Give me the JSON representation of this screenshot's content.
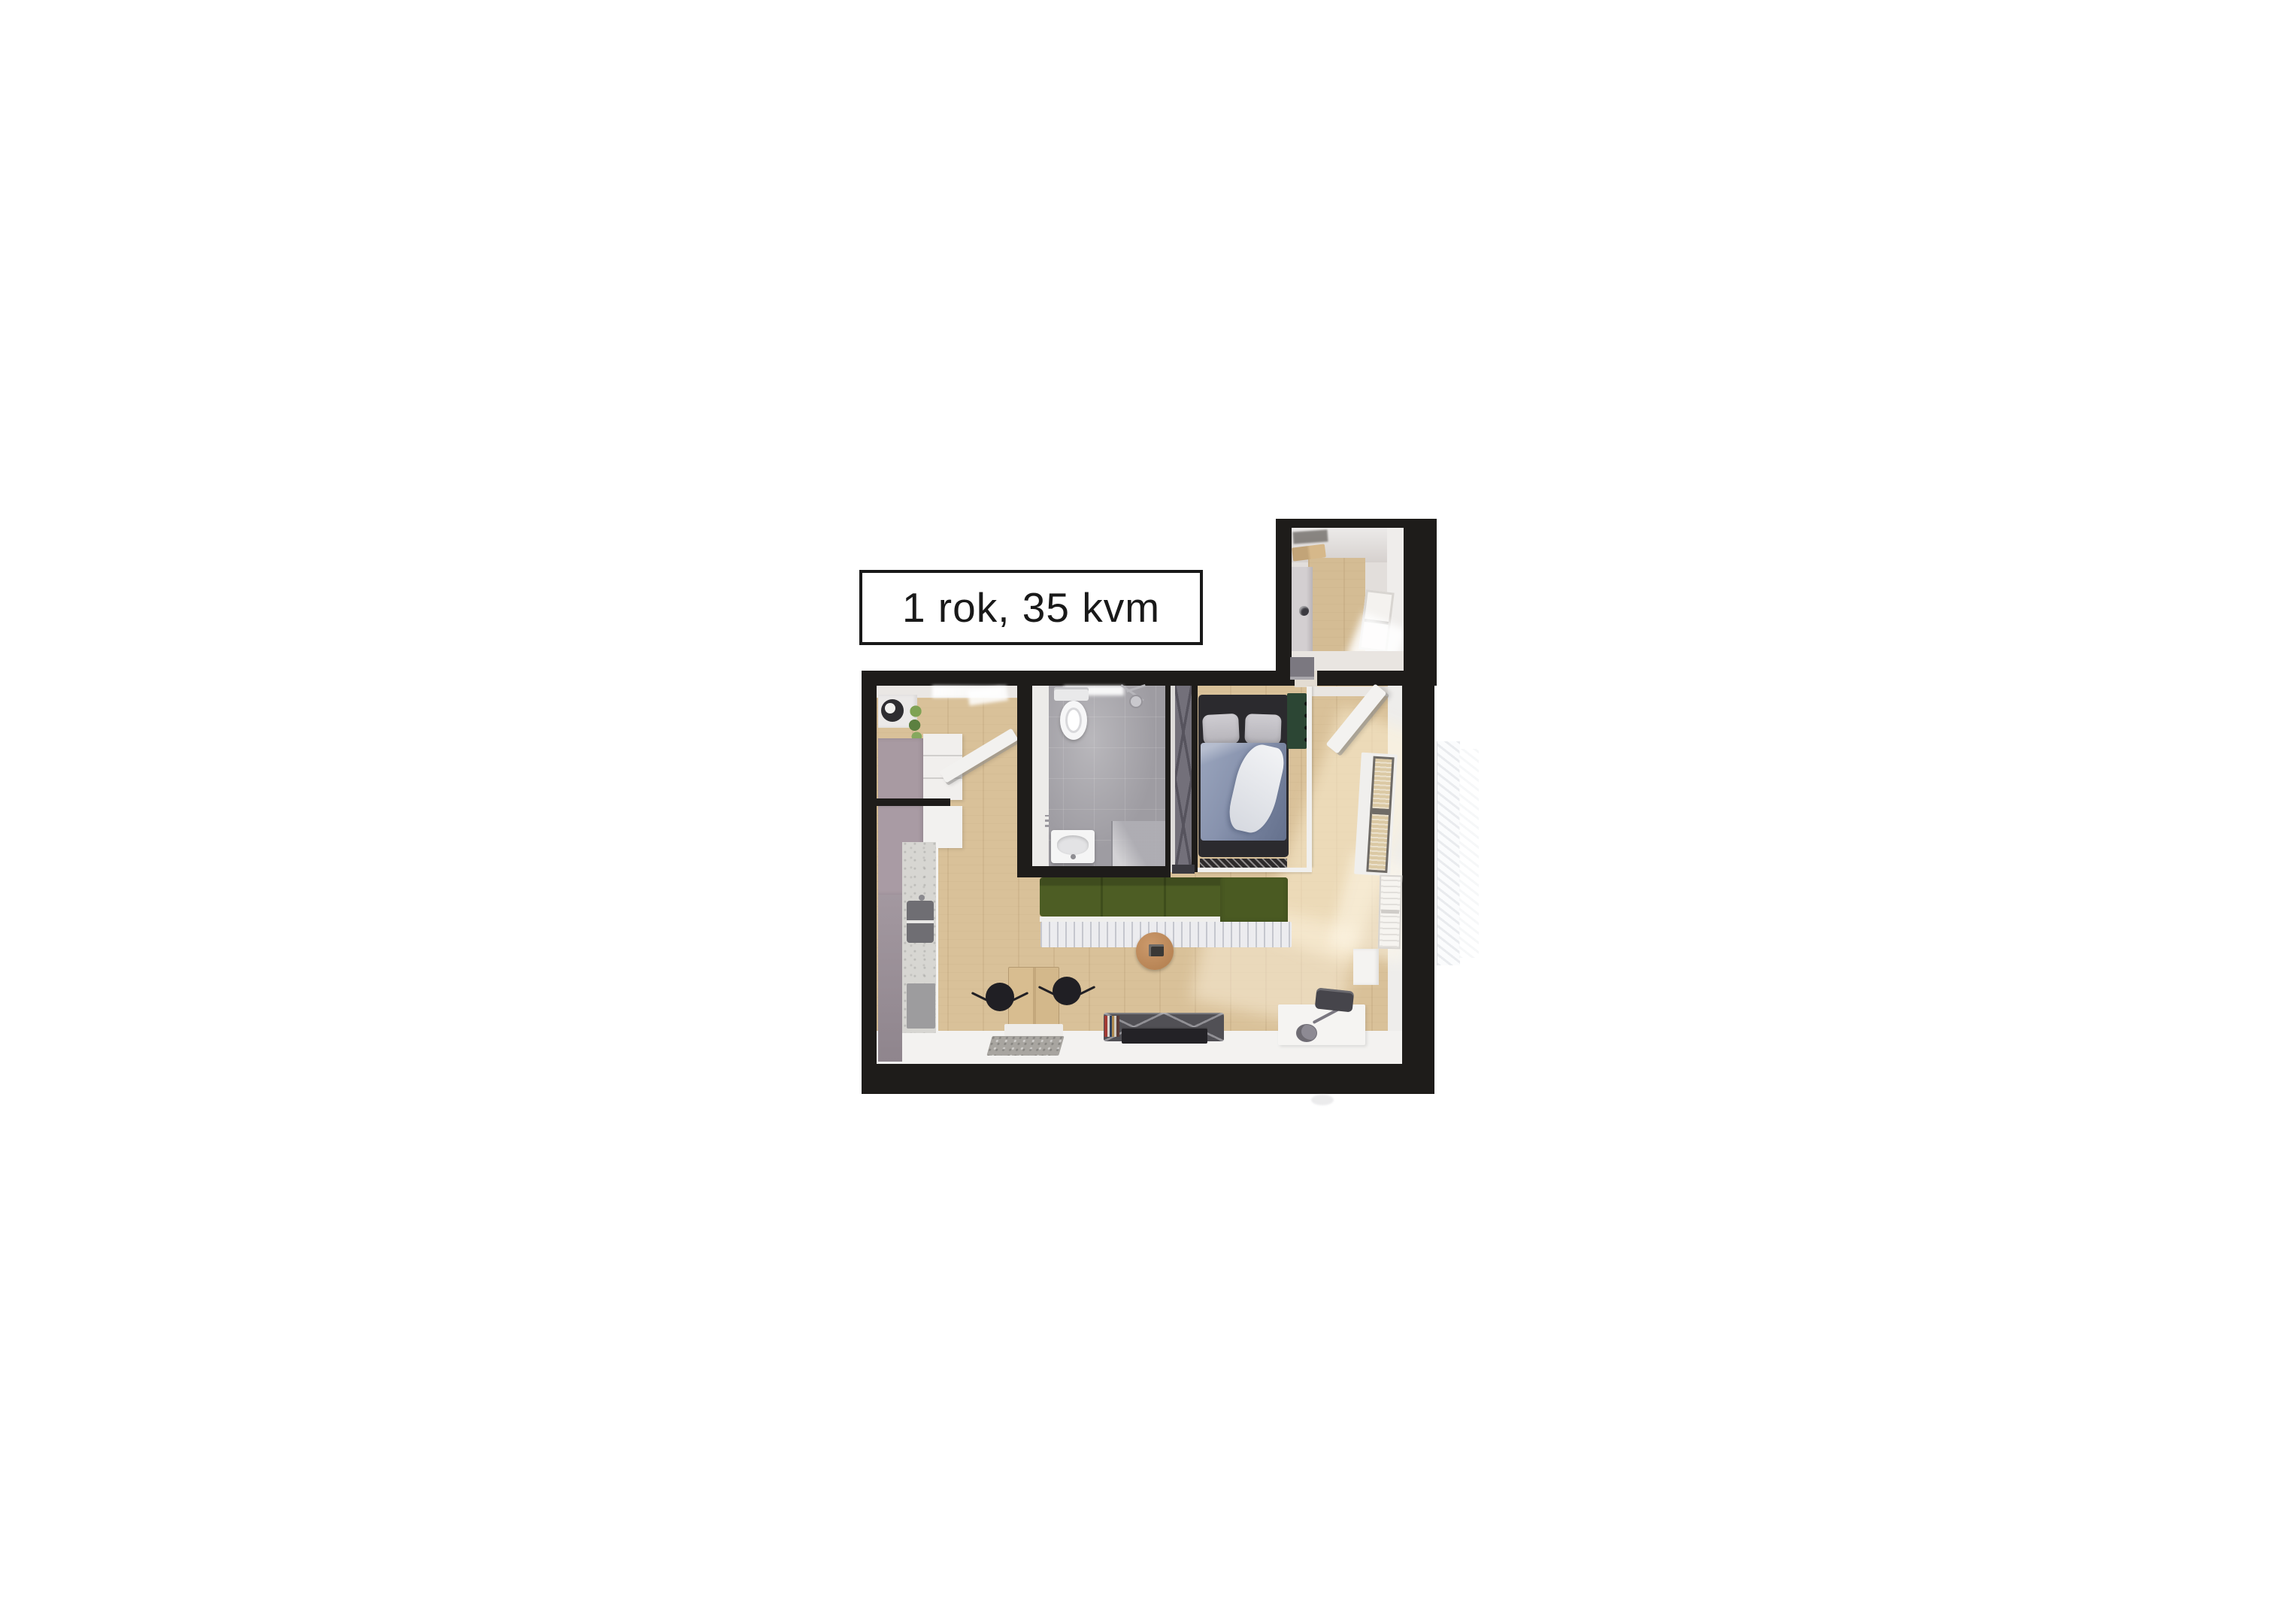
{
  "title_label": "1 rok, 35 kvm",
  "plan": {
    "description": "top-down 3D rendered floor plan of a one-room apartment",
    "rooms": [
      "hallway",
      "kitchen",
      "bathroom",
      "living-room-with-sleeping-area",
      "balcony"
    ],
    "furniture": [
      "wardrobe",
      "kitchen-counter",
      "sink",
      "appliance",
      "toilet",
      "shower",
      "washbasin",
      "double-bed",
      "green-sofa",
      "striped-rug",
      "round-coffee-table",
      "dining-table",
      "dining-chairs",
      "tv-bench",
      "tv",
      "white-desk",
      "guitar",
      "stool",
      "potted-plants",
      "windows",
      "balcony-railing"
    ]
  },
  "colors": {
    "background": "#ffffff",
    "walls": "#1e1c1a",
    "wood_floor": "#d9c199",
    "sofa_green": "#4d5d24",
    "bathroom_tiles": "#9e9ca2",
    "wardrobe_mauve": "#a89aa2",
    "bed_duvet": "#8792ad",
    "label_border": "#191919",
    "label_text": "#191919"
  }
}
